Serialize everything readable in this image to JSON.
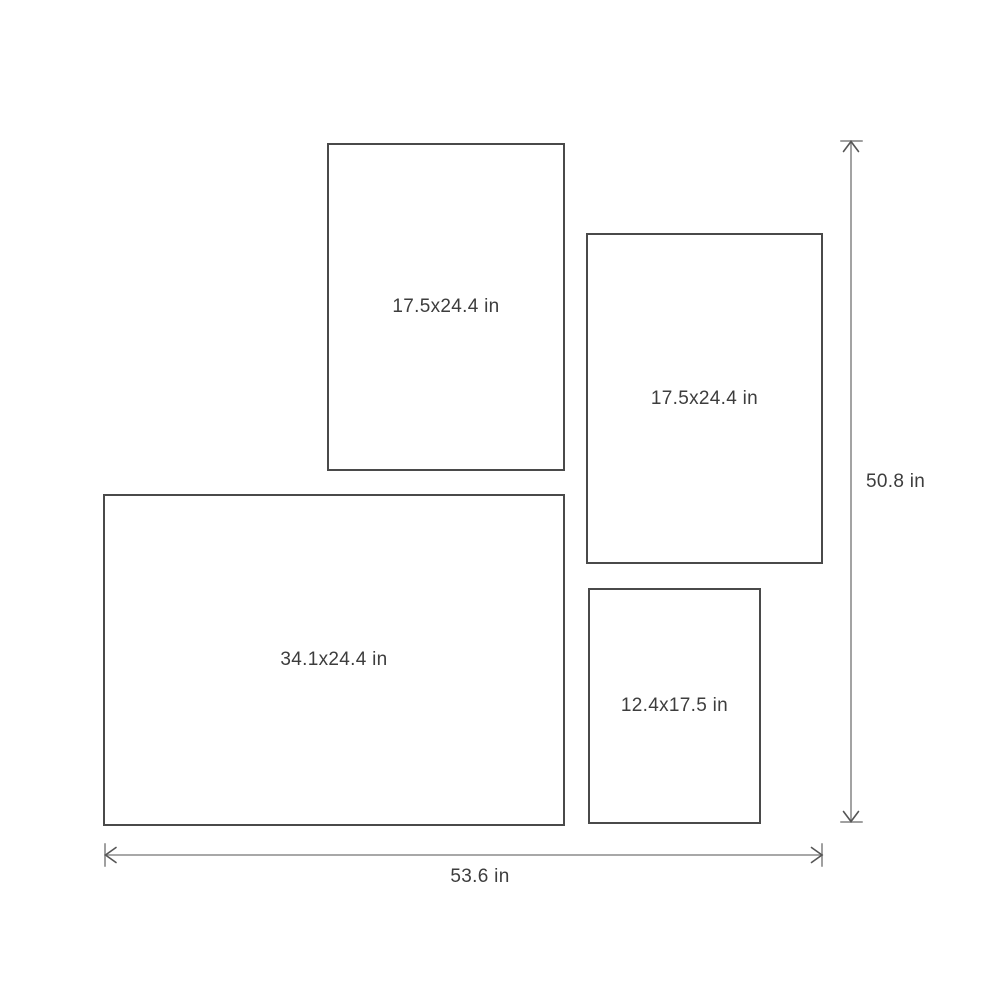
{
  "diagram": {
    "type": "frame-size-layout",
    "unit": "in",
    "boxes": [
      {
        "label": "17.5x24.4 in",
        "width_in": 17.5,
        "height_in": 24.4,
        "position": "top-left"
      },
      {
        "label": "17.5x24.4 in",
        "width_in": 17.5,
        "height_in": 24.4,
        "position": "right"
      },
      {
        "label": "34.1x24.4 in",
        "width_in": 34.1,
        "height_in": 24.4,
        "position": "bottom-left"
      },
      {
        "label": "12.4x17.5 in",
        "width_in": 12.4,
        "height_in": 17.5,
        "position": "bottom-right"
      }
    ],
    "overall_dimensions": {
      "height_label": "50.8 in",
      "height_in": 50.8,
      "width_label": "53.6 in",
      "width_in": 53.6
    },
    "colors": {
      "box_border": "#4a4a4a",
      "dimension_line": "#8c8c8c",
      "arrowhead": "#555555",
      "text": "#3d3d3d",
      "background": "#ffffff"
    }
  }
}
